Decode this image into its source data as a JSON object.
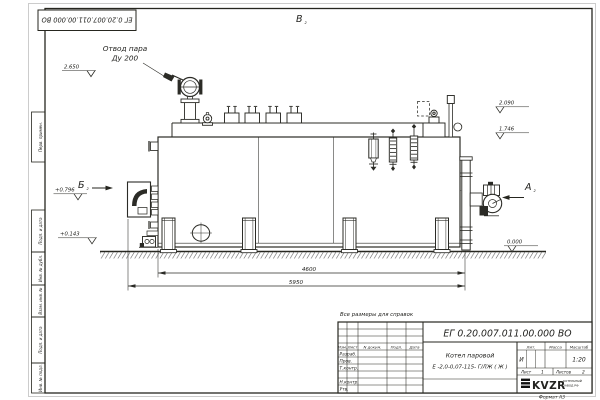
{
  "sheet": {
    "doc_number": "ЕГ 0.20.007.011.00.000  ВО",
    "note": "Все размеры для справок",
    "format_label": "Формат А3"
  },
  "margin": {
    "perv": "Перв. примен.",
    "b1": "Подп. и дата",
    "b2": "Инв. № дубл.",
    "b3": "Взам. инв. №",
    "b4": "Подп. и дата",
    "b5": "Инв. № подл."
  },
  "views": {
    "top_label": "В",
    "left_label": "Б",
    "right_label": "А",
    "sheet_ref": "2"
  },
  "annotations": {
    "steam_line1": "Отвод пара",
    "steam_line2": "Ду 200"
  },
  "levels": {
    "l2650": "2.650",
    "l2090": "2.090",
    "l1746": "1.746",
    "p0796": "+0.796",
    "p0143": "+0.143",
    "zero": "0.000"
  },
  "dims": {
    "width_inner": "4600",
    "width_total": "5950"
  },
  "title_block": {
    "doc_number": "ЕГ 0.20.007.011.00.000  ВО",
    "product_name": "Котел паровой",
    "product_model": "Е -2,0-0,07-115- Г/ЛЖ ( Ж )",
    "col_izm": "Изм.",
    "col_list": "Лист",
    "col_doc": "N докум.",
    "col_podp": "Подп.",
    "col_data": "Дата",
    "row_razrab": "Разраб.",
    "row_prov": "Пров.",
    "row_tkontr": "Т.контр.",
    "row_nkontr": "Н.контр.",
    "row_utv": "Утв.",
    "lit_label": "Лит.",
    "mass_label": "Масса",
    "scale_label": "Масштаб",
    "lit_value": "И",
    "scale_value": "1:20",
    "sheet_label": "Лист",
    "sheet_value": "1",
    "sheets_label": "Листов",
    "sheets_value": "2",
    "logo_text": "KVZR",
    "logo_sub1": "КОТЕЛЬНЫЙ",
    "logo_sub2": "ЗАВОД РФ"
  }
}
